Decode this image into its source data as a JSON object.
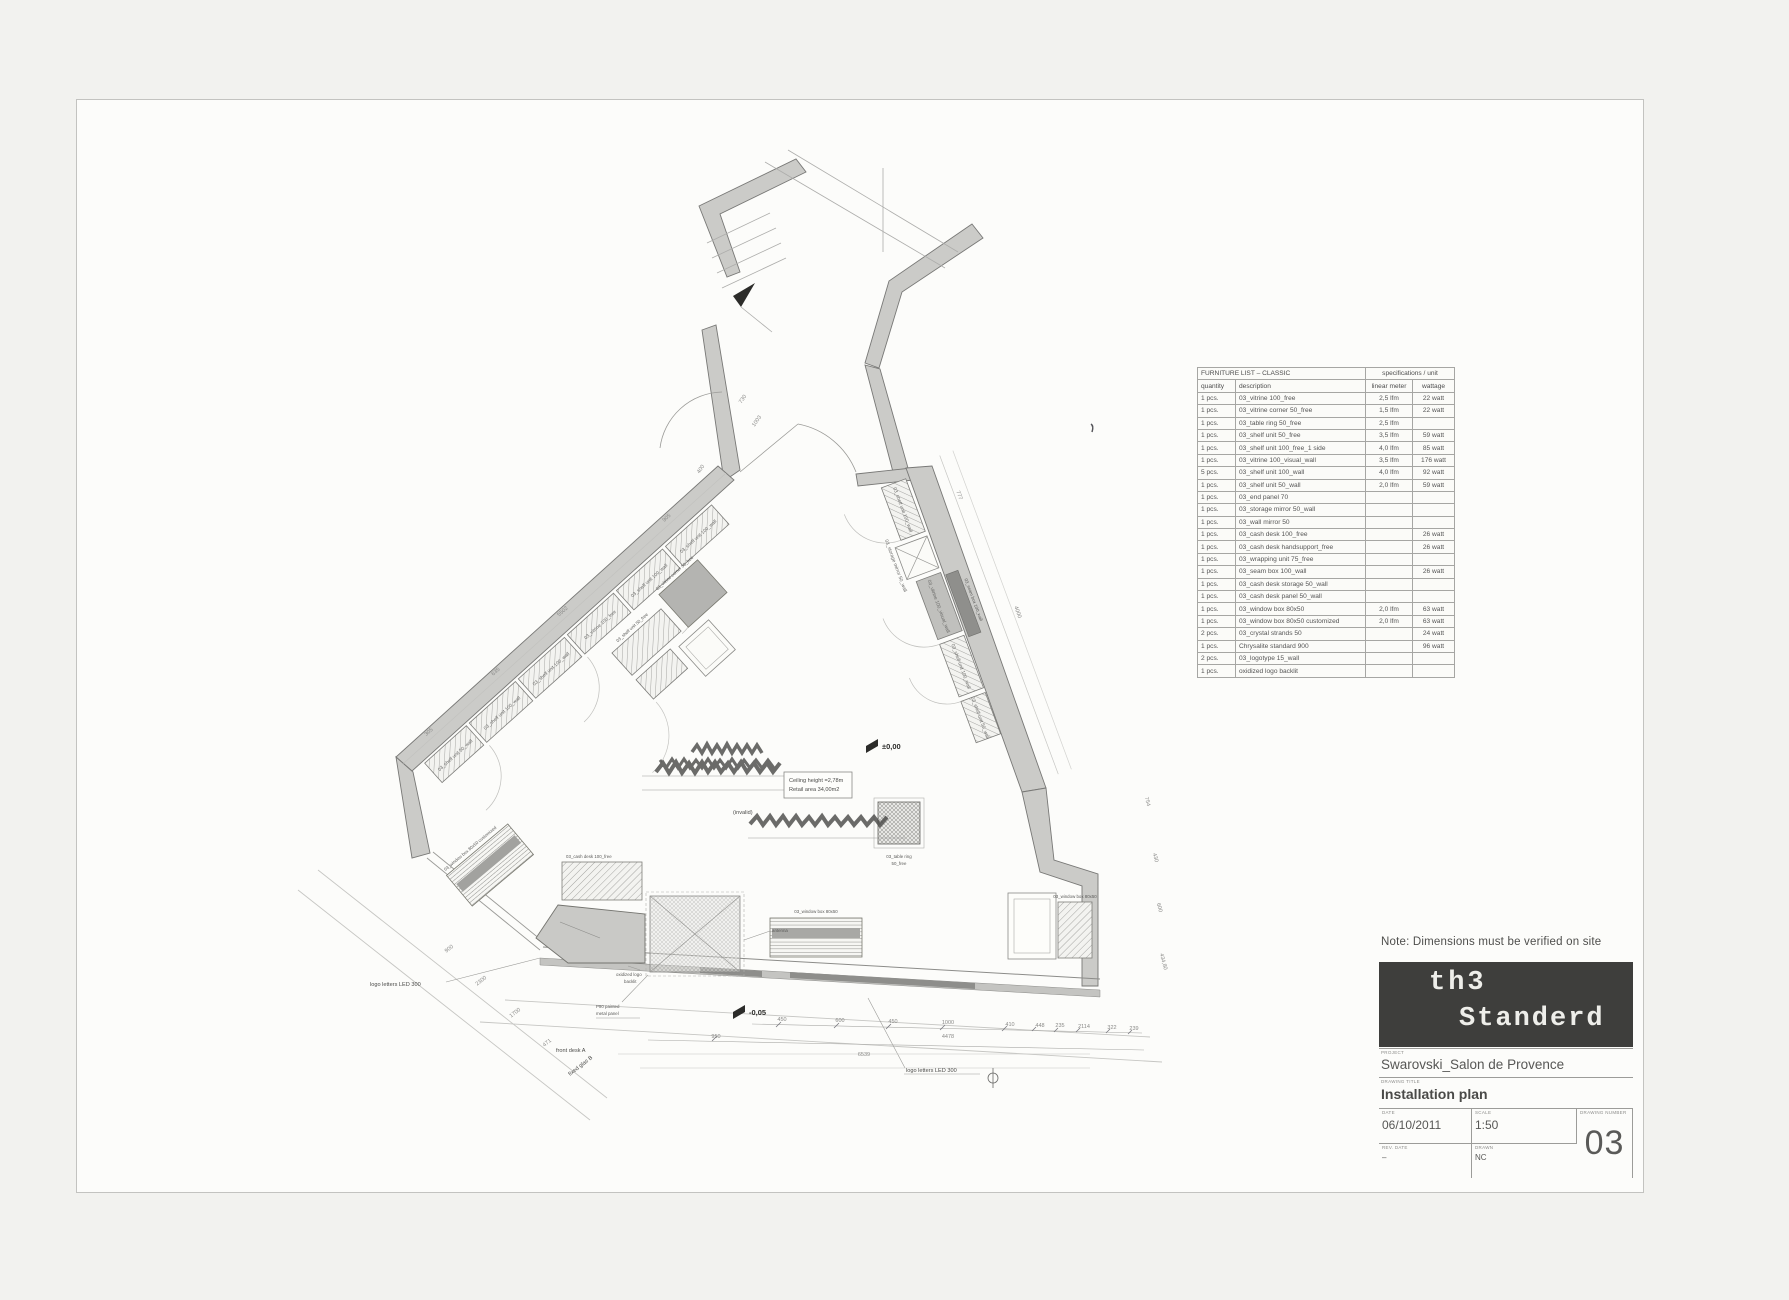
{
  "sheet": {
    "note": "Note: Dimensions must be verified on site",
    "logo": {
      "line1": "th3",
      "line2": "Standerd"
    },
    "title_block": {
      "project_label": "PROJECT",
      "project": "Swarovski_Salon de Provence",
      "drawing_label": "DRAWING TITLE",
      "drawing": "Installation plan",
      "date_label": "DATE",
      "date": "06/10/2011",
      "scale_label": "SCALE",
      "scale": "1:50",
      "rev_label": "REV. DATE",
      "rev": "–",
      "drawn_label": "DRAWN",
      "drawn": "NC",
      "number_label": "DRAWING NUMBER",
      "number": "03"
    }
  },
  "furniture_list": {
    "title": "FURNITURE LIST – CLASSIC",
    "spec_header": "specifications / unit",
    "columns": [
      "quantity",
      "description",
      "linear meter",
      "wattage"
    ],
    "rows": [
      {
        "qty": "1 pcs.",
        "desc": "03_vitrine 100_free",
        "lfm": "2,5 lfm",
        "watt": "22 watt"
      },
      {
        "qty": "1 pcs.",
        "desc": "03_vitrine corner 50_free",
        "lfm": "1,5 lfm",
        "watt": "22 watt"
      },
      {
        "qty": "1 pcs.",
        "desc": "03_table ring 50_free",
        "lfm": "2,5 lfm",
        "watt": ""
      },
      {
        "qty": "1 pcs.",
        "desc": "03_shelf unit 50_free",
        "lfm": "3,5 lfm",
        "watt": "59 watt"
      },
      {
        "qty": "1 pcs.",
        "desc": "03_shelf unit 100_free_1 side",
        "lfm": "4,0 lfm",
        "watt": "85 watt"
      },
      {
        "qty": "1 pcs.",
        "desc": "03_vitrine 100_visual_wall",
        "lfm": "3,5 lfm",
        "watt": "176 watt"
      },
      {
        "qty": "5 pcs.",
        "desc": "03_shelf unit 100_wall",
        "lfm": "4,0 lfm",
        "watt": "92 watt"
      },
      {
        "qty": "1 pcs.",
        "desc": "03_shelf unit 50_wall",
        "lfm": "2,0 lfm",
        "watt": "59 watt"
      },
      {
        "qty": "1 pcs.",
        "desc": "03_end panel 70",
        "lfm": "",
        "watt": ""
      },
      {
        "qty": "1 pcs.",
        "desc": "03_storage mirror 50_wall",
        "lfm": "",
        "watt": ""
      },
      {
        "qty": "1 pcs.",
        "desc": "03_wall mirror 50",
        "lfm": "",
        "watt": ""
      },
      {
        "qty": "1 pcs.",
        "desc": "03_cash desk 100_free",
        "lfm": "",
        "watt": "26 watt"
      },
      {
        "qty": "1 pcs.",
        "desc": "03_cash desk handsupport_free",
        "lfm": "",
        "watt": "26 watt"
      },
      {
        "qty": "1 pcs.",
        "desc": "03_wrapping unit 75_free",
        "lfm": "",
        "watt": ""
      },
      {
        "qty": "1 pcs.",
        "desc": "03_seam box 100_wall",
        "lfm": "",
        "watt": "26 watt"
      },
      {
        "qty": "1 pcs.",
        "desc": "03_cash desk storage 50_wall",
        "lfm": "",
        "watt": ""
      },
      {
        "qty": "1 pcs.",
        "desc": "03_cash desk panel 50_wall",
        "lfm": "",
        "watt": ""
      },
      {
        "qty": "1 pcs.",
        "desc": "03_window box 80x50",
        "lfm": "2,0 lfm",
        "watt": "63 watt"
      },
      {
        "qty": "1 pcs.",
        "desc": "03_window box 80x50 customized",
        "lfm": "2,0 lfm",
        "watt": "63 watt"
      },
      {
        "qty": "2 pcs.",
        "desc": "03_crystal strands 50",
        "lfm": "",
        "watt": "24 watt"
      },
      {
        "qty": "1 pcs.",
        "desc": "Chrysalite standard 900",
        "lfm": "",
        "watt": "96 watt"
      },
      {
        "qty": "2 pcs.",
        "desc": "03_logotype 15_wall",
        "lfm": "",
        "watt": ""
      },
      {
        "qty": "1 pcs.",
        "desc": "oxidized logo backlit",
        "lfm": "",
        "watt": ""
      }
    ]
  },
  "plan": {
    "levels": {
      "zero": "±0,00",
      "front": "-0,05"
    },
    "note_box": {
      "line1": "Ceiling height =2,78m",
      "line2": "Retail area 34,00m2"
    },
    "invalid": "(invalid)",
    "labels": {
      "logo_led": "logo letters LED 300",
      "front_desk": "front desk A",
      "fixed_glas": "fixed glas B",
      "oxidized1": "oxidized logo",
      "oxidized2": "backlit",
      "p90a": "P90 painted",
      "p90b": "metal panel",
      "antenna": "antenna",
      "window_box": "03_window box 80x50",
      "window_box_custom": "03_window box 80x50 customized",
      "table_ring1": "03_table ring",
      "table_ring2": "50_free",
      "cash_desk": "03_cash desk 100_free",
      "seam_box": "03_seam box 100_wall",
      "shelf_free": "03_shelf unit 50_free",
      "vitrine_corner": "03_vitrine corner 50_free"
    },
    "furn_left": [
      "03_shelf unit 100_wall",
      "03_shelf unit 100_wall",
      "03_vitrine 100_free",
      "03_shelf unit 100_wall",
      "03_shelf unit 100_wall",
      "03_shelf unit 50_wall"
    ],
    "furn_right": [
      "03_shelf unit 100_wall",
      "03_storage mirror 50_wall",
      "03_vitrine 100_visual_wall",
      "03_shelf unit 100_wall",
      "03_shelf unit 50_wall"
    ],
    "dims": [
      "450",
      "600",
      "450",
      "1000",
      "410",
      "448",
      "235",
      "2114",
      "322",
      "239",
      "4478",
      "6539",
      "950",
      "900",
      "2300",
      "1700",
      "471",
      "730",
      "1003",
      "400",
      "777",
      "4000",
      "754",
      "430",
      "600",
      "434,80",
      "5502",
      "905",
      "635",
      "305"
    ]
  }
}
